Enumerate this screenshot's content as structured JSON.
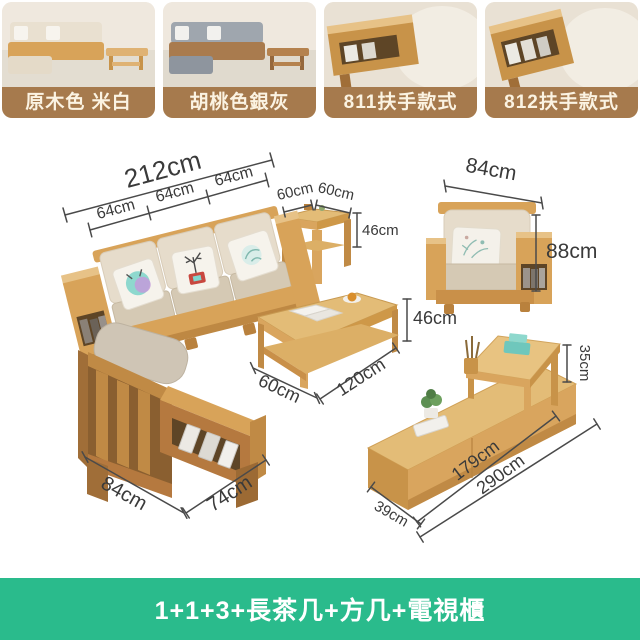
{
  "variants": [
    {
      "label": "原木色 米白"
    },
    {
      "label": "胡桃色銀灰"
    },
    {
      "label": "811扶手款式"
    },
    {
      "label": "812扶手款式"
    }
  ],
  "dims": {
    "sofa_total": "212cm",
    "sofa_seat_1": "64cm",
    "sofa_seat_2": "64cm",
    "sofa_seat_3": "64cm",
    "side_table_width": "60cm",
    "side_table_depth": "60cm",
    "side_table_height": "46cm",
    "armchair_width": "84cm",
    "armchair_height": "88cm",
    "coffee_table_height": "46cm",
    "coffee_table_depth": "60cm",
    "coffee_table_length": "120cm",
    "armchair_back_width": "84cm",
    "armchair_back_depth": "74cm",
    "tv_riser_height": "35cm",
    "tv_depth": "39cm",
    "tv_length_cabinet": "179cm",
    "tv_length_total": "290cm"
  },
  "banner": {
    "text": "1+1+3+長茶几+方几+電視櫃"
  },
  "colors": {
    "banner_green": "#2abb8c",
    "label_bar_brown": "#a67a4d",
    "label_text_cream": "#fbf3e2",
    "wood_light": "#d9a55e",
    "wood_dark": "#c08a45",
    "cushion_back": "#e6dccb",
    "cushion_seat": "#d5c9b4",
    "dimension_text": "#3a3a3a"
  }
}
